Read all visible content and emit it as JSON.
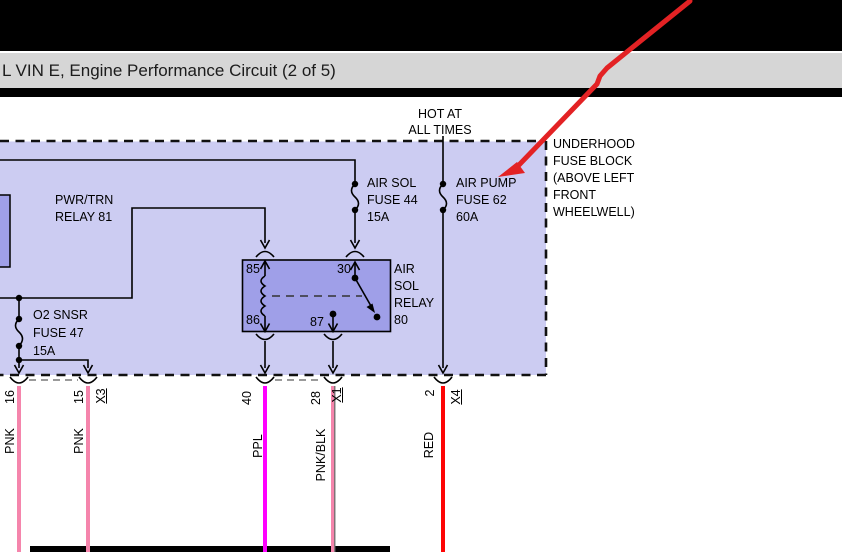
{
  "title_bar": {
    "title": "L VIN E, Engine Performance Circuit (2 of 5)"
  },
  "labels": {
    "hot_at": [
      "HOT AT",
      "ALL TIMES"
    ],
    "air_sol_fuse": [
      "AIR SOL",
      "FUSE 44",
      "15A"
    ],
    "air_pump_fuse": [
      "AIR PUMP",
      "FUSE 62",
      "60A"
    ],
    "underhood_note": [
      "UNDERHOOD",
      "FUSE BLOCK",
      "(ABOVE LEFT",
      "FRONT",
      "WHEELWELL)"
    ],
    "pwr_trn_relay": [
      "PWR/TRN",
      "RELAY 81"
    ],
    "o2_fuse": [
      "O2 SNSR",
      "FUSE 47",
      "15A"
    ],
    "air_sol_relay": [
      "AIR",
      "SOL",
      "RELAY",
      "80"
    ]
  },
  "relay_pins": {
    "coil_top": "85",
    "coil_bottom": "86",
    "common": "30",
    "normally_open": "87"
  },
  "wires": [
    {
      "pin": "16",
      "connector": "",
      "color_name": "PNK",
      "color": "#f585ac"
    },
    {
      "pin": "15",
      "connector": "X3",
      "color_name": "PNK",
      "color": "#f585ac"
    },
    {
      "pin": "40",
      "connector": "",
      "color_name": "PPL",
      "color": "#ff00ff"
    },
    {
      "pin": "28",
      "connector": "X1",
      "color_name": "PNK/BLK",
      "color": "#f585ac",
      "stripe_color": "#6e6e6e"
    },
    {
      "pin": "2",
      "connector": "X4",
      "color_name": "RED",
      "color": "#fe0505"
    }
  ],
  "colors": {
    "fuse_block_fill": "#ccccf2",
    "relay_fill": "#9f9fe8",
    "circuit_line": "#000000",
    "dashed_border": "#111111",
    "connector_dash_gray": "#9a9a9a",
    "annotation_arrow": "#e32224",
    "title_bar_bg": "#d6d6d6"
  }
}
